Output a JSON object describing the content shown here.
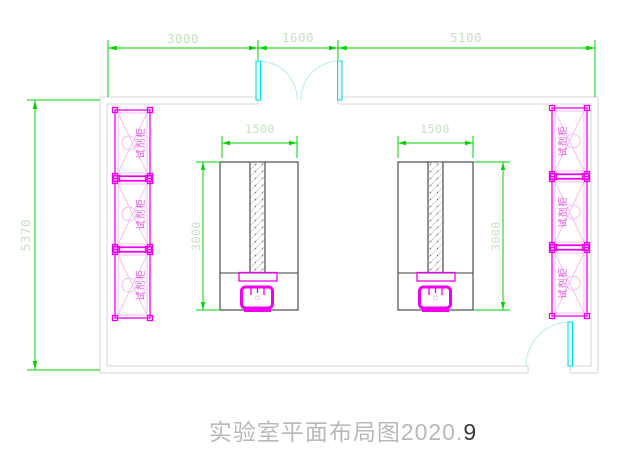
{
  "drawing": {
    "title": {
      "main": "实验室平面布局图2020.",
      "suffix": "9"
    },
    "dimensions": {
      "top": [
        {
          "id": "top-left-span",
          "value": "3000"
        },
        {
          "id": "top-door-span",
          "value": "1600"
        },
        {
          "id": "top-right-span",
          "value": "5100"
        }
      ],
      "left_wall": "5370",
      "left_table": {
        "width": "1500",
        "height": "3000"
      },
      "right_table": {
        "width": "1500",
        "height": "3000"
      }
    },
    "cabinets": {
      "left": [
        {
          "label": "试剂柜"
        },
        {
          "label": "试剂柜"
        },
        {
          "label": "试剂柜"
        }
      ],
      "right": [
        {
          "label": "试剂柜"
        },
        {
          "label": "试剂柜"
        },
        {
          "label": "试剂柜"
        }
      ]
    },
    "colors": {
      "dimension_line": "#00d500",
      "dimension_text": "#c5e2c0",
      "wall": "#d5d5d5",
      "furniture_outline": "#3c3c3c",
      "cabinet": "#ee00ee",
      "cabinet_detail": "#f6aef6",
      "cabinet_text": "#e24fe2",
      "door_leaf": "#00dede",
      "door_swing": "#b4ecec",
      "sink": "#ee00ee",
      "title_text": "#b9b9b9",
      "title_suffix": "#3a3a3a",
      "background": "#ffffff"
    }
  }
}
